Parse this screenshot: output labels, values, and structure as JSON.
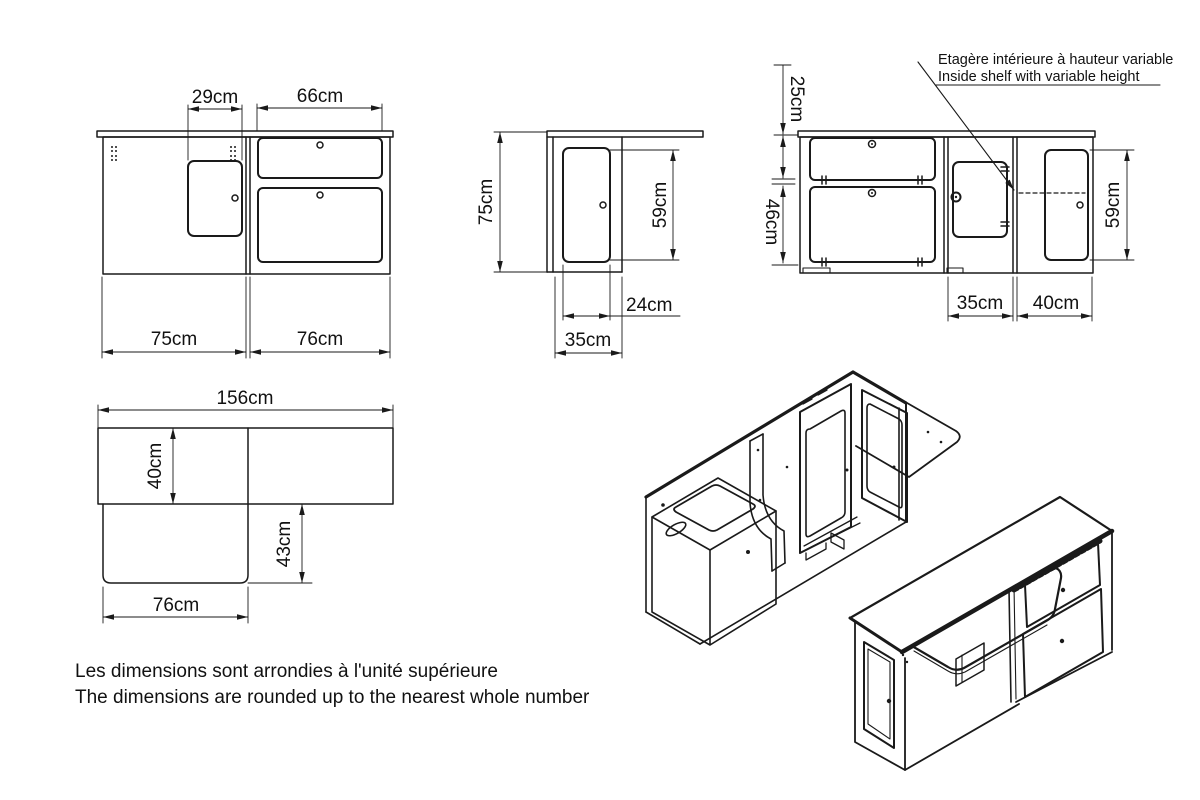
{
  "title": "Furniture dimension drawing",
  "colors": {
    "line": "#1a1a1a",
    "background": "#ffffff"
  },
  "front_view": {
    "door_width": "29cm",
    "drawers_width": "66cm",
    "left_section_width": "75cm",
    "right_section_width": "76cm"
  },
  "side_view": {
    "total_height": "75cm",
    "door_height": "59cm",
    "door_width": "24cm",
    "depth": "35cm"
  },
  "rear_view": {
    "top_flap_height": "25cm",
    "bottom_flap_height": "46cm",
    "middle_section_width": "35cm",
    "right_section_width": "40cm",
    "right_door_height": "59cm",
    "annotation_fr": "Etagère intérieure à hauteur variable",
    "annotation_en": "Inside shelf with variable height"
  },
  "plan_view": {
    "total_width": "156cm",
    "counter_depth": "40cm",
    "table_extension_depth": "43cm",
    "table_extension_width": "76cm"
  },
  "note": {
    "fr": "Les dimensions sont arrondies à l'unité supérieure",
    "en": "The dimensions are rounded up to the nearest whole number"
  }
}
